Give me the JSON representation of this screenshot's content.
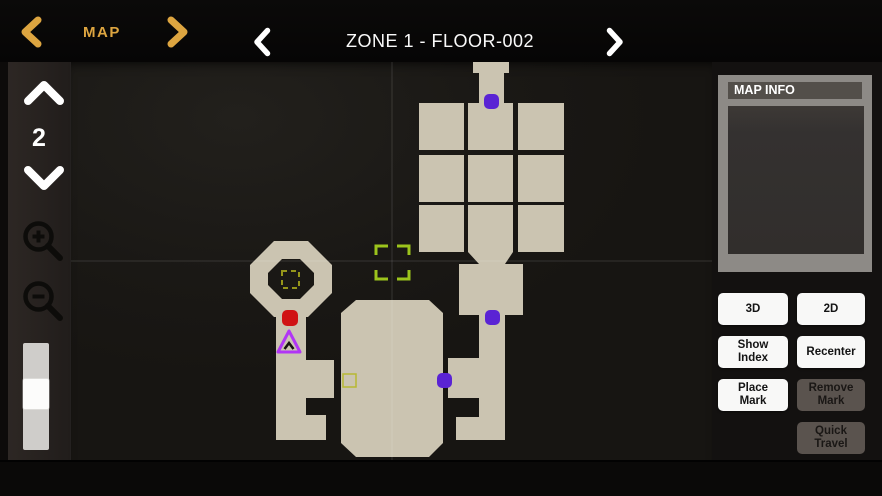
{
  "topbar": {
    "map_label": "MAP",
    "floor_title": "ZONE 1 - FLOOR-002"
  },
  "sidebar": {
    "floor_number": "2"
  },
  "map_info": {
    "header": "MAP INFO"
  },
  "panel_buttons": [
    {
      "name": "3d-button",
      "label": "3D",
      "enabled": true
    },
    {
      "name": "2d-button",
      "label": "2D",
      "enabled": true
    },
    {
      "name": "show-index-button",
      "label": "Show Index",
      "enabled": true
    },
    {
      "name": "recenter-button",
      "label": "Recenter",
      "enabled": true
    },
    {
      "name": "place-mark-button",
      "label": "Place Mark",
      "enabled": true
    },
    {
      "name": "remove-mark-button",
      "label": "Remove Mark",
      "enabled": false
    },
    {
      "name": "button-spacer",
      "label": "",
      "enabled": false,
      "spacer": true
    },
    {
      "name": "quick-travel-button",
      "label": "Quick Travel",
      "enabled": false
    }
  ],
  "colors": {
    "accent_gold": "#dda540",
    "room_fill": "#cbc4b1",
    "marker_purple": "#5a23d4",
    "marker_red": "#d01214",
    "player_magenta": "#b135f5",
    "note_yellow": "#96961a",
    "note_yellow_light": "#b8b832",
    "target_green": "#9cc41c"
  },
  "map": {
    "crosshair": {
      "x": 321,
      "y": 199
    },
    "shapes": [
      {
        "name": "north-entry-corridor",
        "type": "poly",
        "points": "402,0 438,0 438,11 433,11 433,41 408,41 408,11 402,11"
      },
      {
        "name": "grid-room",
        "type": "rect",
        "x": 348,
        "y": 41,
        "w": 45,
        "h": 47
      },
      {
        "name": "grid-room",
        "type": "rect",
        "x": 397,
        "y": 41,
        "w": 45,
        "h": 47
      },
      {
        "name": "grid-room",
        "type": "rect",
        "x": 447,
        "y": 41,
        "w": 46,
        "h": 47
      },
      {
        "name": "grid-room",
        "type": "rect",
        "x": 348,
        "y": 93,
        "w": 45,
        "h": 47
      },
      {
        "name": "grid-room",
        "type": "rect",
        "x": 397,
        "y": 93,
        "w": 45,
        "h": 47
      },
      {
        "name": "grid-room",
        "type": "rect",
        "x": 447,
        "y": 93,
        "w": 46,
        "h": 47
      },
      {
        "name": "grid-room",
        "type": "rect",
        "x": 348,
        "y": 143,
        "w": 45,
        "h": 47
      },
      {
        "name": "grid-room",
        "type": "rect",
        "x": 397,
        "y": 143,
        "w": 45,
        "h": 47
      },
      {
        "name": "grid-room",
        "type": "rect",
        "x": 447,
        "y": 143,
        "w": 46,
        "h": 47
      },
      {
        "name": "grid-funnel",
        "type": "poly",
        "points": "397,190 442,190 434,202 408,202"
      },
      {
        "name": "mid-room",
        "type": "rect",
        "x": 388,
        "y": 202,
        "w": 64,
        "h": 51
      },
      {
        "name": "south-corridor-right",
        "type": "rect",
        "x": 408,
        "y": 253,
        "w": 26,
        "h": 125
      },
      {
        "name": "right-branch-upper",
        "type": "rect",
        "x": 377,
        "y": 296,
        "w": 31,
        "h": 40
      },
      {
        "name": "right-branch-lower",
        "type": "rect",
        "x": 385,
        "y": 355,
        "w": 23,
        "h": 23
      },
      {
        "name": "great-hall",
        "type": "poly",
        "points": "285,238 358,238 372,251 372,381 358,395 285,395 270,381 270,251"
      },
      {
        "name": "octagon-room",
        "type": "path",
        "d": "M203,179 L237,179 L261,203 L261,231 L237,255 L203,255 L179,231 L179,203 Z M211,197 L229,197 L243,211 L243,223 L229,237 L211,237 L197,223 L197,211 Z"
      },
      {
        "name": "south-corridor-left",
        "type": "rect",
        "x": 205,
        "y": 255,
        "w": 30,
        "h": 123
      },
      {
        "name": "left-branch-upper",
        "type": "rect",
        "x": 235,
        "y": 298,
        "w": 28,
        "h": 38
      },
      {
        "name": "left-branch-lower",
        "type": "rect",
        "x": 235,
        "y": 353,
        "w": 20,
        "h": 25
      }
    ],
    "markers": [
      {
        "name": "door-marker-north",
        "type": "dot",
        "color": "marker_purple",
        "x": 413,
        "y": 32,
        "size": 15
      },
      {
        "name": "door-marker-mid",
        "type": "dot",
        "color": "marker_purple",
        "x": 414,
        "y": 248,
        "size": 15
      },
      {
        "name": "door-marker-east",
        "type": "dot",
        "color": "marker_purple",
        "x": 366,
        "y": 311,
        "size": 15
      },
      {
        "name": "poi-marker",
        "type": "dot",
        "color": "marker_red",
        "x": 211,
        "y": 248,
        "size": 16
      },
      {
        "name": "player-marker",
        "type": "triangle",
        "color": "player_magenta",
        "points": "218,269 207,290 229,290",
        "chevron": "M213.5,287 L218,281 L222.5,287"
      },
      {
        "name": "note-marker-octagon",
        "type": "dashed-square",
        "color": "note_yellow",
        "x": 211,
        "y": 209,
        "size": 17
      },
      {
        "name": "note-marker-hall",
        "type": "square",
        "color": "note_yellow_light",
        "x": 272,
        "y": 312,
        "size": 13
      },
      {
        "name": "cursor-target",
        "type": "target",
        "color": "target_green",
        "x": 305,
        "y": 184,
        "size": 33
      }
    ]
  }
}
